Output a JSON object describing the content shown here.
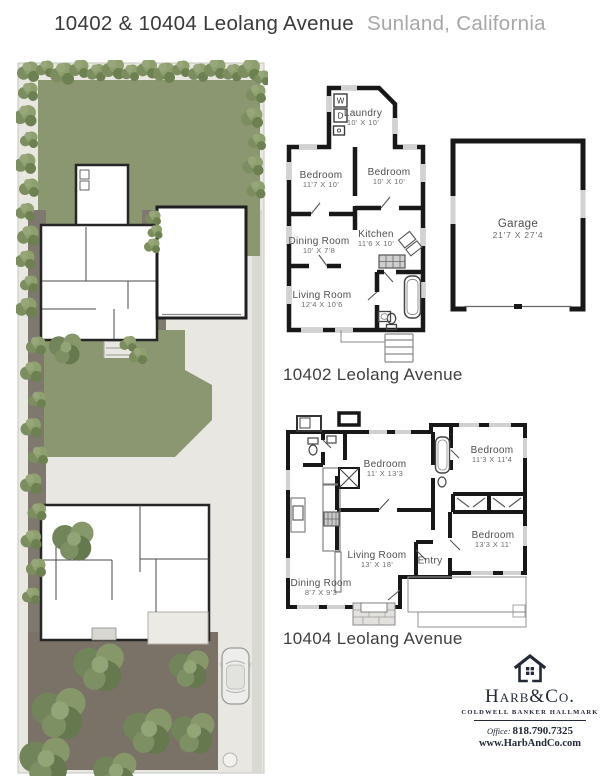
{
  "title": {
    "address": "10402 & 10404 Leolang Avenue",
    "location": "Sunland, California"
  },
  "plans": {
    "p10402": {
      "caption": "10402 Leolang Avenue",
      "rooms": {
        "laundry": {
          "name": "Laundry",
          "dims": "10' X 10'"
        },
        "bedroom_left": {
          "name": "Bedroom",
          "dims": "11'7 X 10'"
        },
        "bedroom_right": {
          "name": "Bedroom",
          "dims": "10' X 10'"
        },
        "kitchen": {
          "name": "Kitchen",
          "dims": "11'6 X 10'"
        },
        "dining": {
          "name": "Dining Room",
          "dims": "10' X 7'8"
        },
        "living": {
          "name": "Living Room",
          "dims": "12'4 X 10'6"
        }
      },
      "fixtures": {
        "washer": "W",
        "dryer": "D"
      }
    },
    "garage": {
      "name": "Garage",
      "dims": "21'7 X 27'4"
    },
    "p10404": {
      "caption": "10404 Leolang Avenue",
      "rooms": {
        "bedroom_center": {
          "name": "Bedroom",
          "dims": "11' X 13'3"
        },
        "bedroom_top_right": {
          "name": "Bedroom",
          "dims": "11'3 X 11'4"
        },
        "bedroom_bottom_right": {
          "name": "Bedroom",
          "dims": "13'3 X 11'"
        },
        "living": {
          "name": "Living Room",
          "dims": "13' X 18'"
        },
        "entry": {
          "name": "Entry",
          "dims": ""
        },
        "dining": {
          "name": "Dining Room",
          "dims": "8'7 X 9'3"
        }
      }
    }
  },
  "branding": {
    "name": "Harb&Co.",
    "subtitle": "Coldwell Banker Hallmark",
    "office_label": "Office:",
    "phone": "818.790.7325",
    "website": "www.HarbAndCo.com"
  },
  "colors": {
    "lawn": "#8a9770",
    "concrete": "#e8e7e2",
    "soil": "#7b7267",
    "wall": "#181818",
    "brand_navy": "#232936"
  }
}
